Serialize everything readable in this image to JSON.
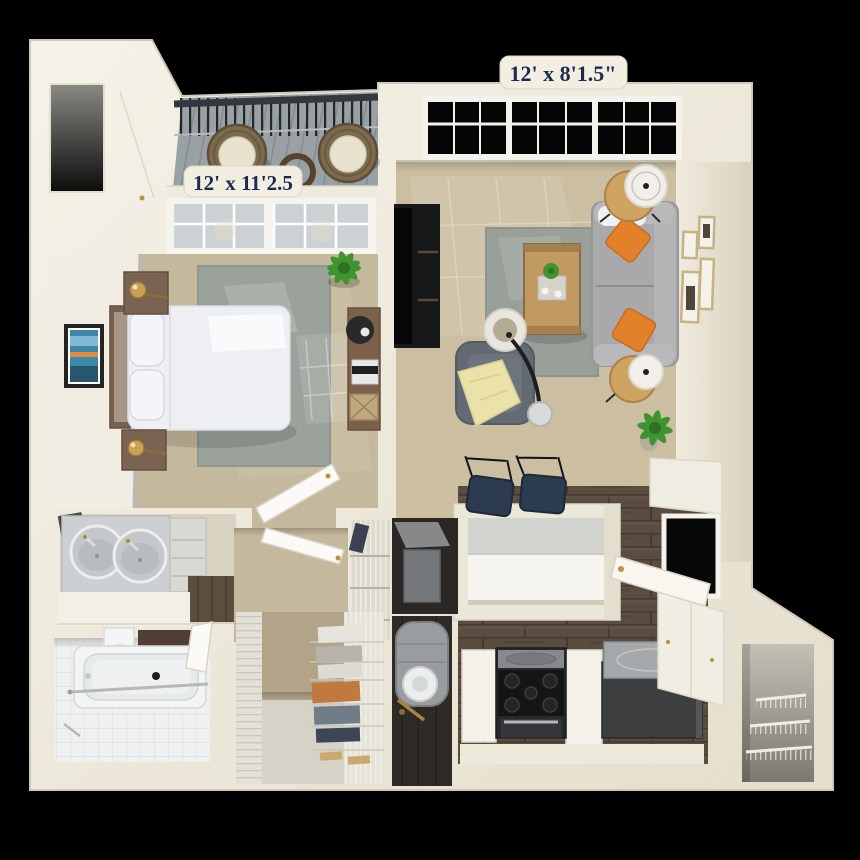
{
  "scene": {
    "type": "3d-apartment-floorplan-render",
    "background": "#000000"
  },
  "labels": {
    "living_room_dim": "12' x 8'1.5\"",
    "bedroom_dim": "12' x 11'2.5"
  },
  "label_style": {
    "text_color": "#1d2a4f",
    "tab_color": "#f2eee1"
  },
  "palette": {
    "wall_cream": "#efebdd",
    "carpet_tan": "#c8bb9e",
    "rug_gray": "#9aa29b",
    "wood_floor_dark": "#5a4c40",
    "balcony_plank": "#9aa1a5",
    "sofa_gray": "#a9a9ab",
    "pillow_orange": "#e2812a",
    "throw_yellow": "#eae2a9",
    "cabinet_white": "#f3f1ea",
    "appliance_dark": "#28292b",
    "tile_white": "#eef0f1",
    "brass": "#b8923f"
  },
  "rooms": {
    "balcony": {
      "name": "balcony",
      "furniture": [
        "railing",
        "wicker-chair",
        "wicker-chair",
        "round-table"
      ]
    },
    "bedroom": {
      "name": "bedroom",
      "dimensions": "12' x 11'2.5",
      "furniture": [
        "bed",
        "headboard",
        "nightstand",
        "nightstand",
        "brass-lamp",
        "brass-lamp",
        "wall-art",
        "area-rug",
        "desk",
        "desk-chair",
        "plant"
      ]
    },
    "living_room": {
      "name": "living room",
      "dimensions": "12' x 8'1.5\"",
      "furniture": [
        "sofa",
        "orange-pillows",
        "coffee-table",
        "area-rug",
        "armchair",
        "throw-blanket",
        "arc-floor-lamp",
        "tv-console",
        "side-table-lamp",
        "side-table-lamp",
        "plant",
        "gallery-frames"
      ]
    },
    "kitchen": {
      "name": "kitchen",
      "furniture": [
        "breakfast-bar",
        "bar-stool",
        "bar-stool",
        "range-stove",
        "refrigerator",
        "base-cabinets",
        "upper-cabinets",
        "window",
        "entry-door"
      ]
    },
    "bathroom": {
      "name": "bathroom",
      "furniture": [
        "bathtub",
        "toilet",
        "shower-rod",
        "tile-floor"
      ]
    },
    "vanity_area": {
      "name": "vanity / laundry nook",
      "furniture": [
        "double-sink-vanity",
        "drawer-cabinet",
        "counter"
      ]
    },
    "walk_in_closet": {
      "name": "walk-in closet",
      "furniture": [
        "wire-shelving",
        "folded-clothes",
        "shoes"
      ]
    },
    "utility": {
      "name": "utility closets",
      "furniture": [
        "water-heater",
        "hvac-unit",
        "coat-closet-wire-shelves"
      ]
    },
    "pantry": {
      "name": "entry pantry",
      "furniture": [
        "wire-shelves"
      ]
    }
  }
}
